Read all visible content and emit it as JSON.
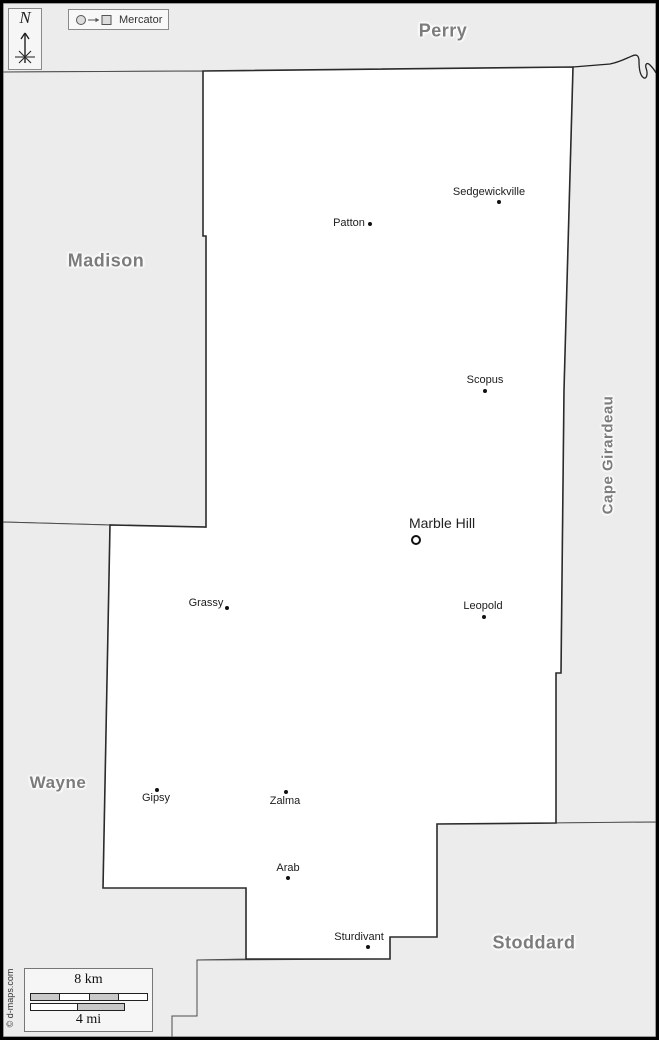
{
  "compass": {
    "north": "N"
  },
  "projection_legend": {
    "label": "Mercator"
  },
  "neighbor_counties": {
    "perry": "Perry",
    "madison": "Madison",
    "wayne": "Wayne",
    "stoddard": "Stoddard",
    "cape_girardeau": "Cape Girardeau"
  },
  "towns": [
    {
      "name": "Sedgewickville",
      "marker": "dot"
    },
    {
      "name": "Patton",
      "marker": "dot"
    },
    {
      "name": "Scopus",
      "marker": "dot"
    },
    {
      "name": "Marble Hill",
      "marker": "ring"
    },
    {
      "name": "Grassy",
      "marker": "dot"
    },
    {
      "name": "Leopold",
      "marker": "dot"
    },
    {
      "name": "Gipsy",
      "marker": "dot"
    },
    {
      "name": "Zalma",
      "marker": "dot"
    },
    {
      "name": "Arab",
      "marker": "dot"
    },
    {
      "name": "Sturdivant",
      "marker": "dot"
    }
  ],
  "scale_bar": {
    "km": "8 km",
    "mi": "4 mi"
  },
  "copyright": "© d-maps.com",
  "colors": {
    "neighbor_fill": "#ececec",
    "focus_fill": "#ffffff",
    "boundary": "#4d4d4d",
    "focus_outline": "#2b2b2b",
    "county_label": "#7c7c7c",
    "frame": "#000000"
  }
}
